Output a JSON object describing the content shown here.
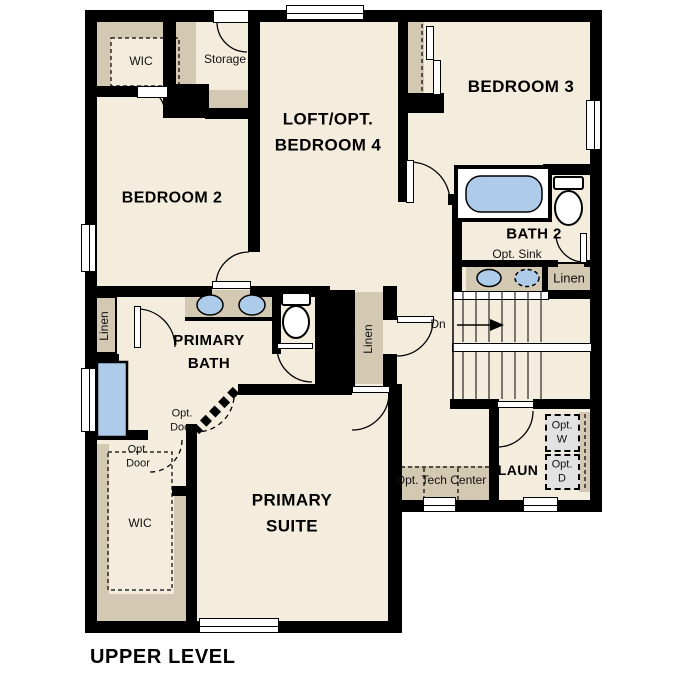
{
  "title": "UPPER LEVEL",
  "colors": {
    "wall": "#000000",
    "floor": "#f4edde",
    "casework": "#d3c8b2",
    "fixture": "#aecbea",
    "appliance": "#e2e2e2"
  },
  "rooms": {
    "wic2": "WIC",
    "storage": "Storage",
    "bedroom2": "BEDROOM 2",
    "loft": "LOFT/OPT.\nBEDROOM 4",
    "bedroom3": "BEDROOM 3",
    "bath2": "BATH 2",
    "primary_bath": "PRIMARY\nBATH",
    "primary_suite": "PRIMARY\nSUITE",
    "primary_wic": "WIC",
    "laundry": "LAUN"
  },
  "annotations": {
    "opt_sink": "Opt. Sink",
    "linen_bath2": "Linen",
    "linen_hall": "Linen",
    "linen_primary": "Linen",
    "stairs_dn": "Dn",
    "opt_door_bath": "Opt.\nDoor",
    "opt_door_wic": "Opt.\nDoor",
    "opt_washer": "Opt.\nW",
    "opt_dryer": "Opt.\nD",
    "opt_tech_center": "Opt. Tech Center"
  }
}
